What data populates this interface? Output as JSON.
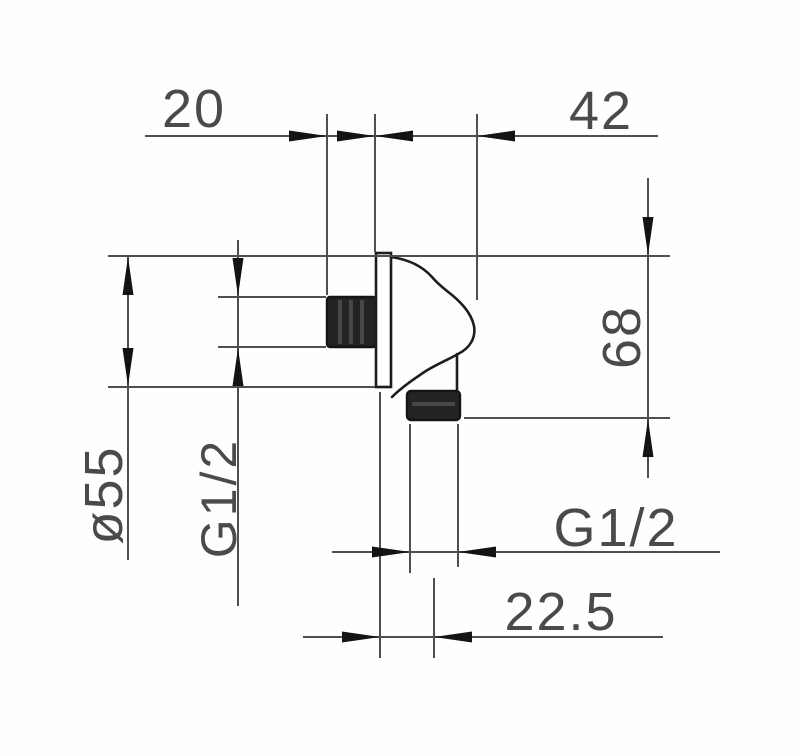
{
  "drawing": {
    "type": "technical-dimension-drawing",
    "labels": {
      "top_width": "20",
      "body_depth": "42",
      "height": "68",
      "flange_diameter": "ø55",
      "inlet_thread": "G1/2",
      "outlet_thread": "G1/2",
      "outlet_offset": "22.5"
    },
    "colors": {
      "line": "#4f4f4f",
      "arrow": "#141414",
      "outline": "#1d1d1d",
      "thread_fill": "#232323",
      "text": "#4a4a4a",
      "background": "#ffffff"
    }
  }
}
